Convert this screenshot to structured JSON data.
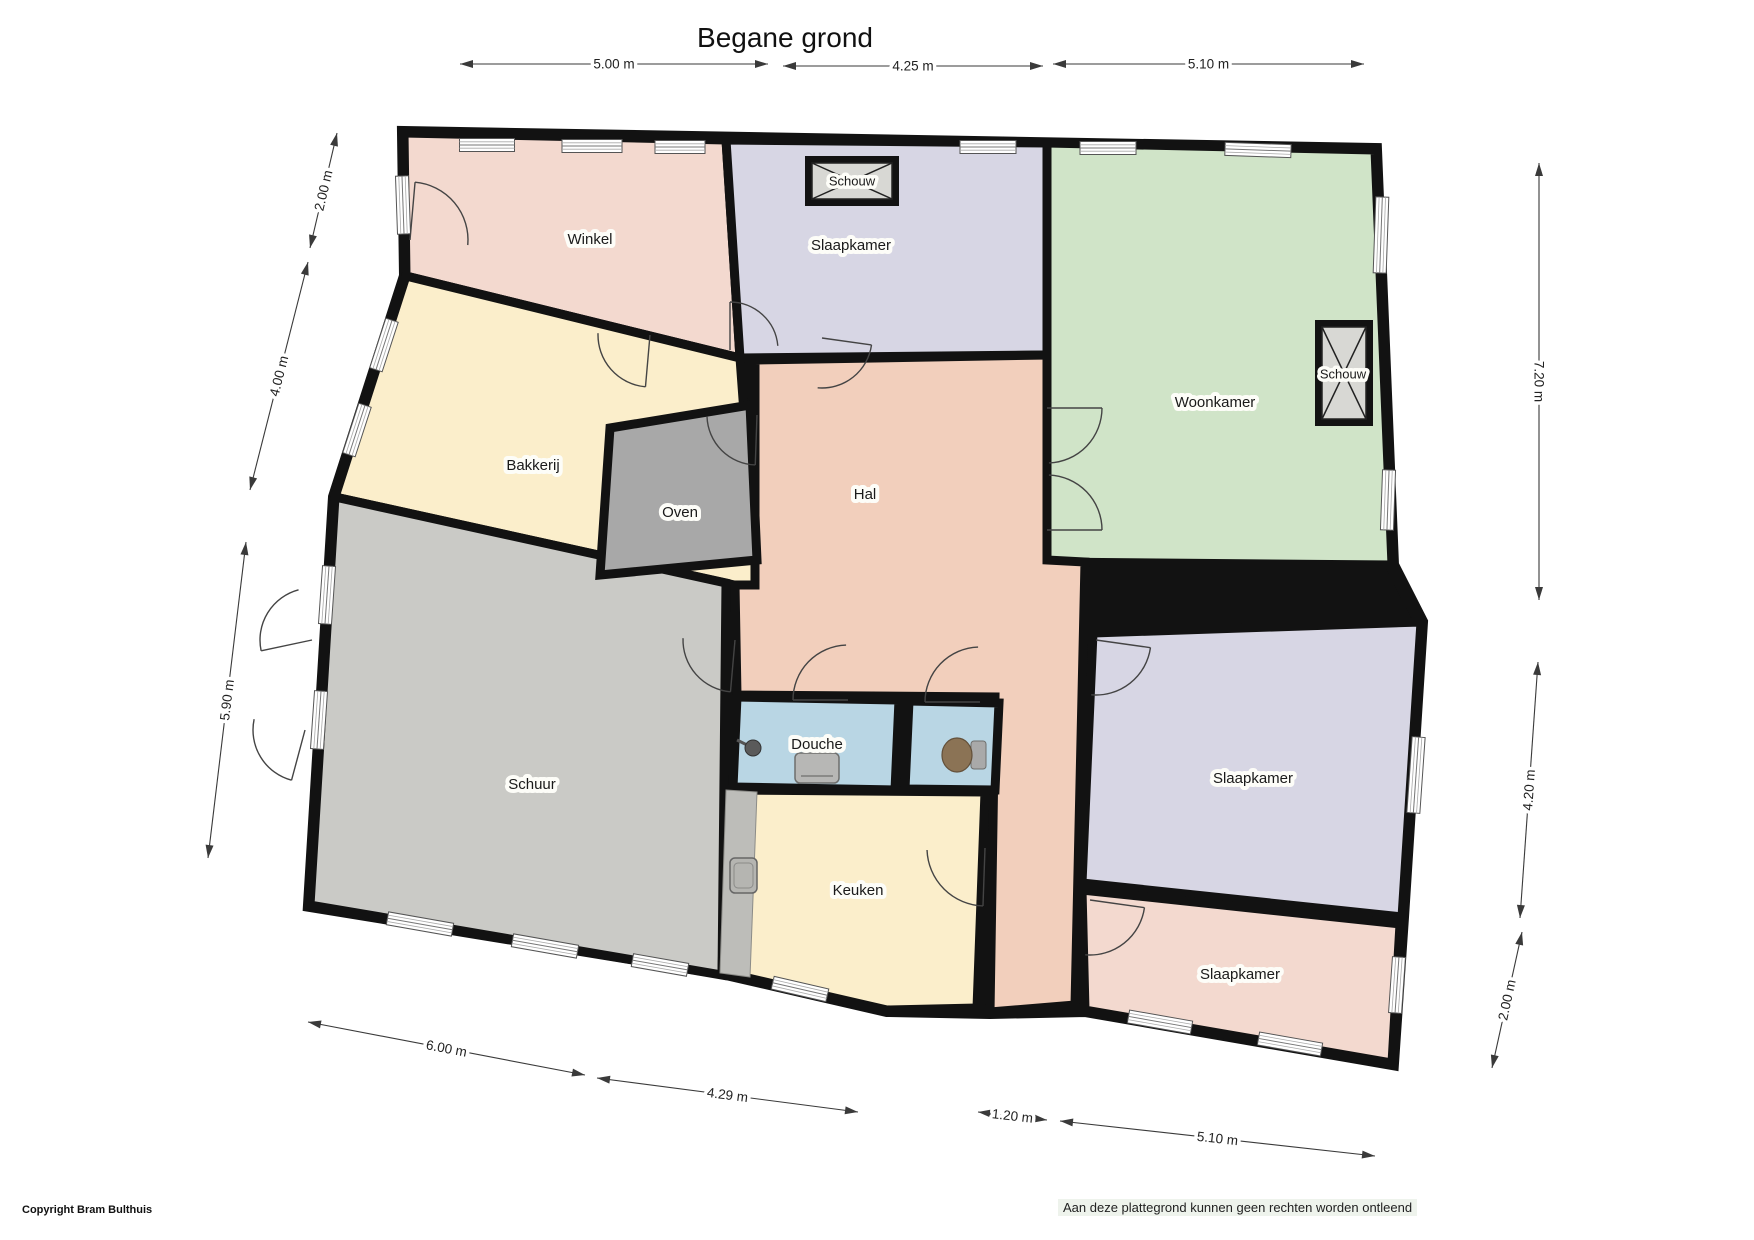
{
  "title": "Begane grond",
  "footer": {
    "copyright": "Copyright Bram Bulthuis",
    "disclaimer": "Aan deze plattegrond kunnen geen rechten worden ontleend"
  },
  "colors": {
    "wall": "#121212",
    "pink": "#f3d9cf",
    "purple": "#d7d6e4",
    "green": "#d0e4c8",
    "cream": "#fbeecb",
    "peach": "#f2cfbc",
    "oven_gray": "#a8a8a8",
    "schuur_gray": "#cacac6",
    "bath_blue": "#b9d6e4",
    "fireplace_gray": "#d8d8d4",
    "counter_gray": "#bdbdb9",
    "dim_line": "#3a3a3a"
  },
  "outline": [
    [
      404,
      133
    ],
    [
      1375,
      150
    ],
    [
      1392,
      565
    ],
    [
      1421,
      622
    ],
    [
      1402,
      917
    ],
    [
      1392,
      1063
    ],
    [
      1085,
      1010
    ],
    [
      990,
      1012
    ],
    [
      887,
      1010
    ],
    [
      722,
      972
    ],
    [
      310,
      905
    ],
    [
      335,
      497
    ],
    [
      406,
      276
    ]
  ],
  "rooms": [
    {
      "id": "winkel",
      "label": "Winkel",
      "fill": "pink",
      "points": [
        [
          404,
          133
        ],
        [
          726,
          140
        ],
        [
          740,
          358
        ],
        [
          406,
          276
        ]
      ],
      "lx": 590,
      "ly": 239
    },
    {
      "id": "slaapkamer-boven",
      "label": "Slaapkamer",
      "fill": "purple",
      "points": [
        [
          726,
          140
        ],
        [
          1047,
          143
        ],
        [
          1047,
          355
        ],
        [
          740,
          358
        ]
      ],
      "lx": 851,
      "ly": 245
    },
    {
      "id": "woonkamer",
      "label": "Woonkamer",
      "fill": "green",
      "points": [
        [
          1047,
          143
        ],
        [
          1375,
          150
        ],
        [
          1392,
          565
        ],
        [
          1047,
          562
        ]
      ],
      "lx": 1215,
      "ly": 402
    },
    {
      "id": "bakkerij",
      "label": "Bakkerij",
      "fill": "cream",
      "points": [
        [
          406,
          276
        ],
        [
          740,
          358
        ],
        [
          757,
          590
        ],
        [
          335,
          497
        ]
      ],
      "lx": 533,
      "ly": 465
    },
    {
      "id": "hal",
      "label": "Hal",
      "fill": "peach",
      "points": [
        [
          755,
          360
        ],
        [
          1047,
          355
        ],
        [
          1047,
          560
        ],
        [
          1085,
          562
        ],
        [
          1075,
          1005
        ],
        [
          990,
          1012
        ],
        [
          995,
          697
        ],
        [
          737,
          695
        ],
        [
          735,
          585
        ],
        [
          755,
          585
        ]
      ],
      "lx": 865,
      "ly": 494
    },
    {
      "id": "schuur",
      "label": "Schuur",
      "fill": "schuur_gray",
      "points": [
        [
          335,
          497
        ],
        [
          726,
          583
        ],
        [
          722,
          975
        ],
        [
          310,
          905
        ]
      ],
      "lx": 532,
      "ly": 784
    },
    {
      "id": "oven",
      "label": "Oven",
      "fill": "oven_gray",
      "points": [
        [
          610,
          428
        ],
        [
          750,
          405
        ],
        [
          757,
          560
        ],
        [
          600,
          575
        ]
      ],
      "lx": 680,
      "ly": 512
    },
    {
      "id": "douche",
      "label": "Douche",
      "fill": "bath_blue",
      "points": [
        [
          737,
          697
        ],
        [
          899,
          700
        ],
        [
          895,
          790
        ],
        [
          733,
          787
        ]
      ],
      "lx": 817,
      "ly": 744
    },
    {
      "id": "wc",
      "label": "",
      "fill": "bath_blue",
      "points": [
        [
          909,
          701
        ],
        [
          999,
          703
        ],
        [
          995,
          790
        ],
        [
          905,
          789
        ]
      ],
      "lx": 0,
      "ly": 0
    },
    {
      "id": "keuken",
      "label": "Keuken",
      "fill": "cream",
      "points": [
        [
          728,
          790
        ],
        [
          985,
          792
        ],
        [
          977,
          1008
        ],
        [
          887,
          1010
        ],
        [
          722,
          972
        ]
      ],
      "lx": 858,
      "ly": 890
    },
    {
      "id": "slaapkamer-rechts",
      "label": "Slaapkamer",
      "fill": "purple",
      "points": [
        [
          1093,
          633
        ],
        [
          1421,
          622
        ],
        [
          1402,
          917
        ],
        [
          1082,
          883
        ]
      ],
      "lx": 1253,
      "ly": 778
    },
    {
      "id": "slaapkamer-onder",
      "label": "Slaapkamer",
      "fill": "pink",
      "points": [
        [
          1082,
          890
        ],
        [
          1400,
          924
        ],
        [
          1392,
          1063
        ],
        [
          1085,
          1010
        ]
      ],
      "lx": 1240,
      "ly": 974
    }
  ],
  "fireplaces": [
    {
      "label": "Schouw",
      "x": 805,
      "y": 156,
      "w": 94,
      "h": 50,
      "lx": 852,
      "ly": 181
    },
    {
      "label": "Schouw",
      "x": 1315,
      "y": 320,
      "w": 58,
      "h": 106,
      "lx": 1343,
      "ly": 374
    }
  ],
  "windows": [
    {
      "cx": 487,
      "cy": 145,
      "len": 55,
      "a": 0
    },
    {
      "cx": 592,
      "cy": 146,
      "len": 60,
      "a": 0
    },
    {
      "cx": 680,
      "cy": 147,
      "len": 50,
      "a": 0
    },
    {
      "cx": 988,
      "cy": 147,
      "len": 56,
      "a": 0
    },
    {
      "cx": 1108,
      "cy": 148,
      "len": 56,
      "a": 0
    },
    {
      "cx": 1258,
      "cy": 150,
      "len": 66,
      "a": 2
    },
    {
      "cx": 403,
      "cy": 205,
      "len": 58,
      "a": 88
    },
    {
      "cx": 384,
      "cy": 345,
      "len": 52,
      "a": 108
    },
    {
      "cx": 357,
      "cy": 430,
      "len": 52,
      "a": 108
    },
    {
      "cx": 327,
      "cy": 595,
      "len": 58,
      "a": 94
    },
    {
      "cx": 319,
      "cy": 720,
      "len": 58,
      "a": 94
    },
    {
      "cx": 420,
      "cy": 924,
      "len": 66,
      "a": 10
    },
    {
      "cx": 545,
      "cy": 946,
      "len": 66,
      "a": 10
    },
    {
      "cx": 660,
      "cy": 965,
      "len": 56,
      "a": 10
    },
    {
      "cx": 800,
      "cy": 989,
      "len": 56,
      "a": 13
    },
    {
      "cx": 1160,
      "cy": 1022,
      "len": 64,
      "a": 10
    },
    {
      "cx": 1290,
      "cy": 1044,
      "len": 64,
      "a": 10
    },
    {
      "cx": 1381,
      "cy": 235,
      "len": 76,
      "a": 92
    },
    {
      "cx": 1388,
      "cy": 500,
      "len": 60,
      "a": 92
    },
    {
      "cx": 1416,
      "cy": 775,
      "len": 76,
      "a": 94
    },
    {
      "cx": 1397,
      "cy": 985,
      "len": 56,
      "a": 94
    }
  ],
  "doors": [
    {
      "hx": 410,
      "hy": 240,
      "r": 58,
      "a1": -85,
      "a2": 5
    },
    {
      "hx": 650,
      "hy": 335,
      "r": 52,
      "a1": 95,
      "a2": 182
    },
    {
      "hx": 730,
      "hy": 350,
      "r": 48,
      "a1": -90,
      "a2": -5
    },
    {
      "hx": 822,
      "hy": 338,
      "r": 50,
      "a1": 8,
      "a2": 95
    },
    {
      "hx": 757,
      "hy": 415,
      "r": 50,
      "a1": 92,
      "a2": 178
    },
    {
      "hx": 1047,
      "hy": 408,
      "r": 55,
      "a1": 0,
      "a2": 88
    },
    {
      "hx": 1047,
      "hy": 530,
      "r": 55,
      "a1": 0,
      "a2": -88
    },
    {
      "hx": 735,
      "hy": 640,
      "r": 52,
      "a1": 95,
      "a2": 182
    },
    {
      "hx": 848,
      "hy": 700,
      "r": 55,
      "a1": 180,
      "a2": 268
    },
    {
      "hx": 980,
      "hy": 702,
      "r": 55,
      "a1": 180,
      "a2": 268
    },
    {
      "hx": 985,
      "hy": 848,
      "r": 58,
      "a1": 92,
      "a2": 178
    },
    {
      "hx": 1096,
      "hy": 640,
      "r": 55,
      "a1": 8,
      "a2": 95
    },
    {
      "hx": 1090,
      "hy": 900,
      "r": 55,
      "a1": 8,
      "a2": 95
    },
    {
      "hx": 312,
      "hy": 640,
      "r": 52,
      "a1": 168,
      "a2": 255
    },
    {
      "hx": 305,
      "hy": 730,
      "r": 52,
      "a1": 105,
      "a2": 192
    }
  ],
  "fixtures": [
    {
      "type": "counter",
      "points": [
        [
          726,
          790
        ],
        [
          757,
          792
        ],
        [
          750,
          977
        ],
        [
          720,
          973
        ]
      ]
    },
    {
      "type": "sink",
      "x": 730,
      "y": 858,
      "w": 27,
      "h": 35
    },
    {
      "type": "shower-head",
      "x": 753,
      "y": 748
    },
    {
      "type": "shower-tray",
      "x": 795,
      "y": 753,
      "w": 44,
      "h": 30
    },
    {
      "type": "toilet",
      "x": 957,
      "y": 755
    }
  ],
  "dimensions": [
    {
      "text": "5.00 m",
      "x1": 460,
      "y1": 64,
      "x2": 768,
      "y2": 64
    },
    {
      "text": "4.25 m",
      "x1": 783,
      "y1": 66,
      "x2": 1043,
      "y2": 66
    },
    {
      "text": "5.10 m",
      "x1": 1053,
      "y1": 64,
      "x2": 1364,
      "y2": 64
    },
    {
      "text": "2.00 m",
      "x1": 337,
      "y1": 133,
      "x2": 310,
      "y2": 248
    },
    {
      "text": "4.00 m",
      "x1": 308,
      "y1": 262,
      "x2": 250,
      "y2": 490
    },
    {
      "text": "5.90 m",
      "x1": 246,
      "y1": 542,
      "x2": 208,
      "y2": 858
    },
    {
      "text": "7.20 m",
      "x1": 1539,
      "y1": 163,
      "x2": 1539,
      "y2": 600
    },
    {
      "text": "4.20 m",
      "x1": 1538,
      "y1": 662,
      "x2": 1520,
      "y2": 918
    },
    {
      "text": "2.00 m",
      "x1": 1522,
      "y1": 932,
      "x2": 1492,
      "y2": 1068
    },
    {
      "text": "6.00 m",
      "x1": 308,
      "y1": 1022,
      "x2": 585,
      "y2": 1075
    },
    {
      "text": "4.29 m",
      "x1": 597,
      "y1": 1078,
      "x2": 858,
      "y2": 1112
    },
    {
      "text": "1.20 m",
      "x1": 978,
      "y1": 1112,
      "x2": 1047,
      "y2": 1120
    },
    {
      "text": "5.10 m",
      "x1": 1060,
      "y1": 1121,
      "x2": 1375,
      "y2": 1156
    }
  ]
}
